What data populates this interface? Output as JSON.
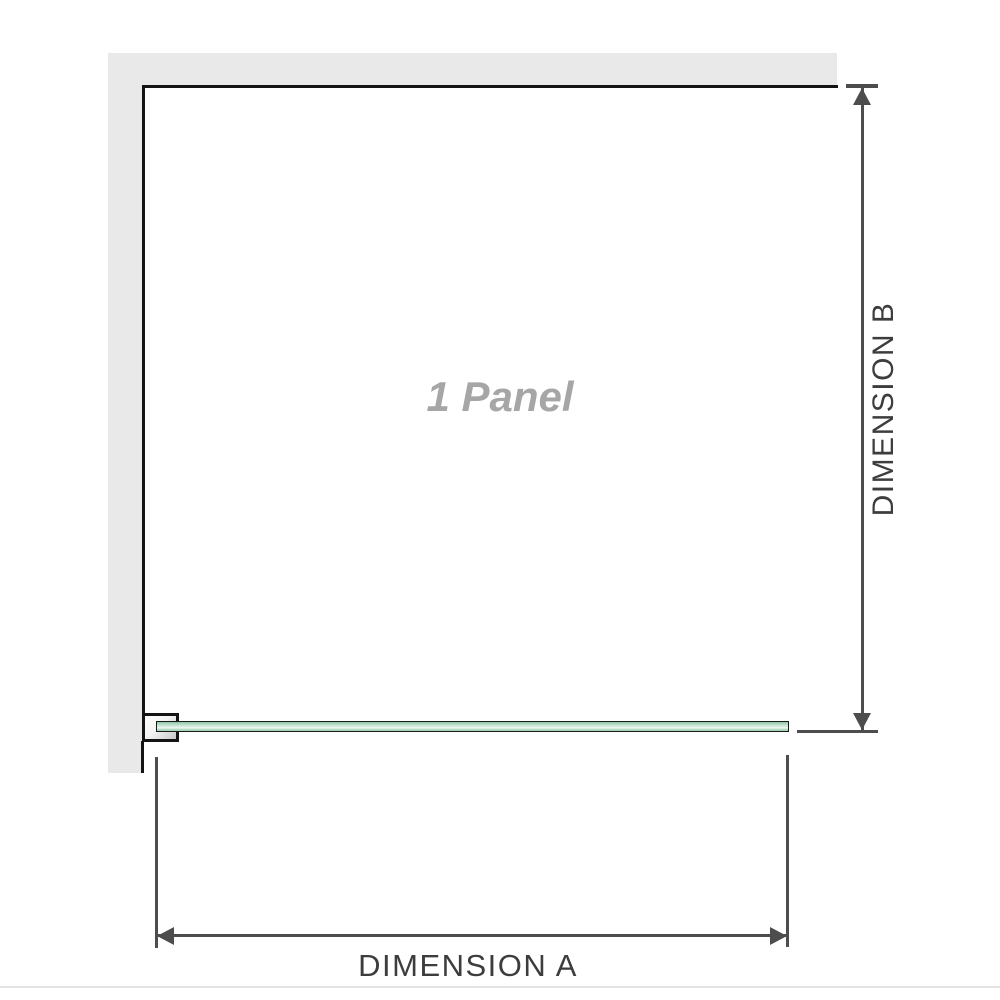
{
  "diagram": {
    "title": "1 Panel",
    "panel_label": "1 Panel",
    "dimension_a_label": "DIMENSION A",
    "dimension_b_label": "DIMENSION B"
  },
  "colors": {
    "wall_gray": "#e9e9e9",
    "border_black": "#141414",
    "dim_line": "#4d4d4d",
    "label_gray": "#a6a6a6",
    "dim_text": "#3d3d3d",
    "glass_dark": "#96c9a9",
    "glass_light": "#e9f6ee",
    "baseline_gray": "#e4e4e4"
  }
}
